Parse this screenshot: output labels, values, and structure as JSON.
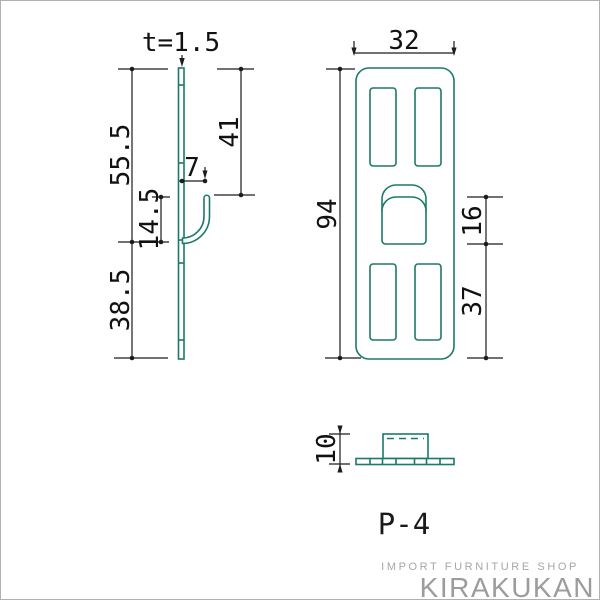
{
  "part_label": "P-4",
  "views": {
    "side": {
      "thickness": "t=1.5",
      "upper_height": "55.5",
      "hook_top": "41",
      "hook_offset": "7",
      "hook_height": "14.5",
      "lower_height": "38.5"
    },
    "front": {
      "width": "32",
      "height": "94",
      "hook_slot": "16",
      "lower": "37"
    },
    "bottom": {
      "depth": "10"
    }
  },
  "footer": {
    "tagline": "IMPORT FURNITURE SHOP",
    "brand": "KIRAKUKAN"
  },
  "colors": {
    "outline_teal": "#1b7a68",
    "dimension_dark": "#1c1c1c",
    "logo_gray": "#9c9c9c"
  }
}
